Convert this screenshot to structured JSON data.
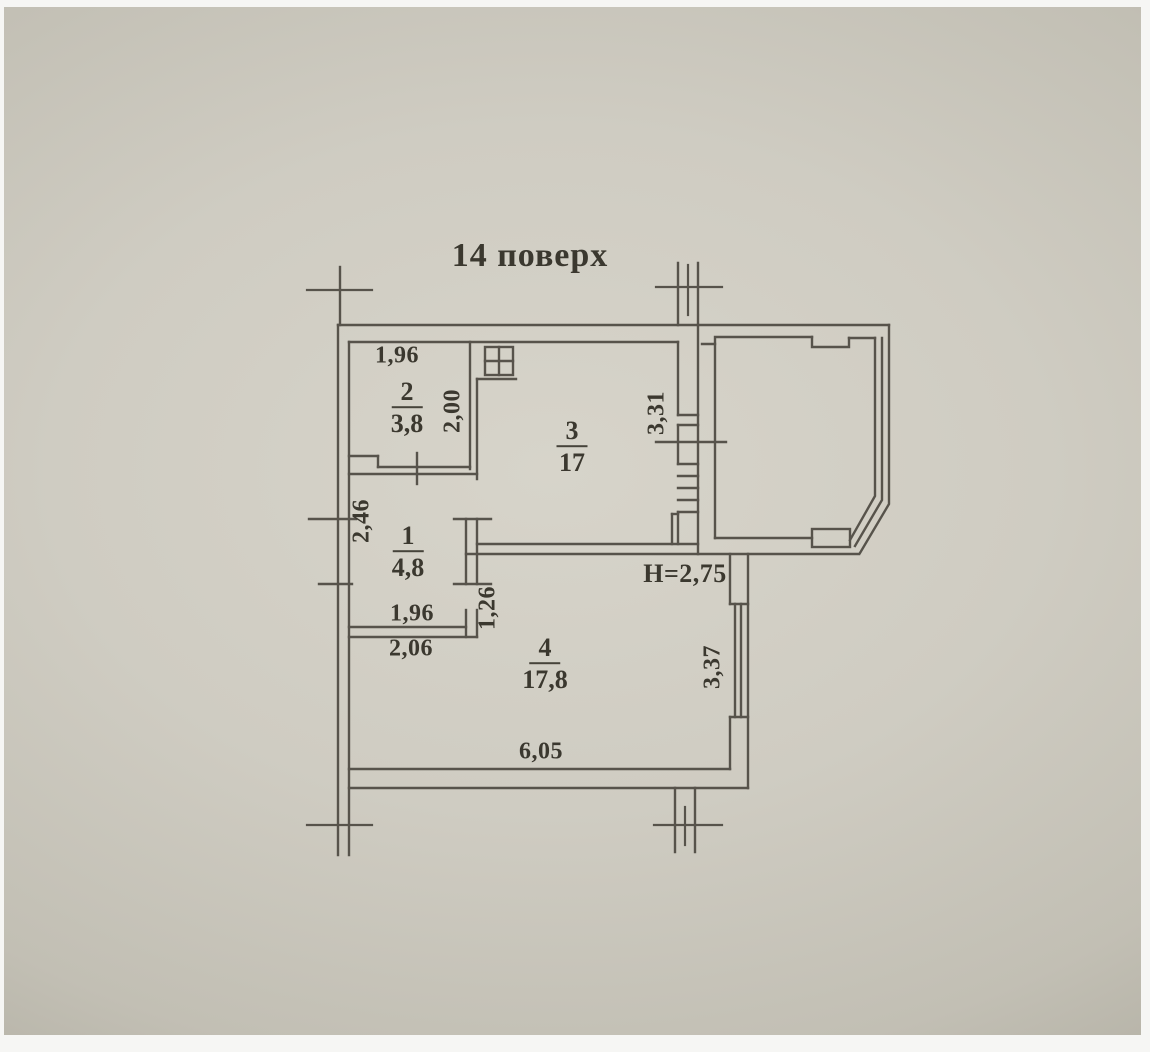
{
  "title": "14 поверх",
  "rooms": {
    "room1": {
      "number": "1",
      "area": "4,8",
      "dim_left": "2,46",
      "dim_bottom_inner": "1,96",
      "dim_bottom_outer": "2,06"
    },
    "room2": {
      "number": "2",
      "area": "3,8",
      "dim_top": "1,96",
      "dim_right": "2,00"
    },
    "room3": {
      "number": "3",
      "area": "17",
      "dim_right": "3,31"
    },
    "room4": {
      "number": "4",
      "area": "17,8",
      "dim_bottom": "6,05",
      "dim_right": "3,37",
      "ceiling_height": "Н=2,75"
    }
  },
  "passage": {
    "width": "1,26"
  },
  "colors": {
    "paper_light": "#d7d4ca",
    "paper_dark": "#a19d92",
    "line": "#57534b",
    "ink": "#3b382f"
  }
}
